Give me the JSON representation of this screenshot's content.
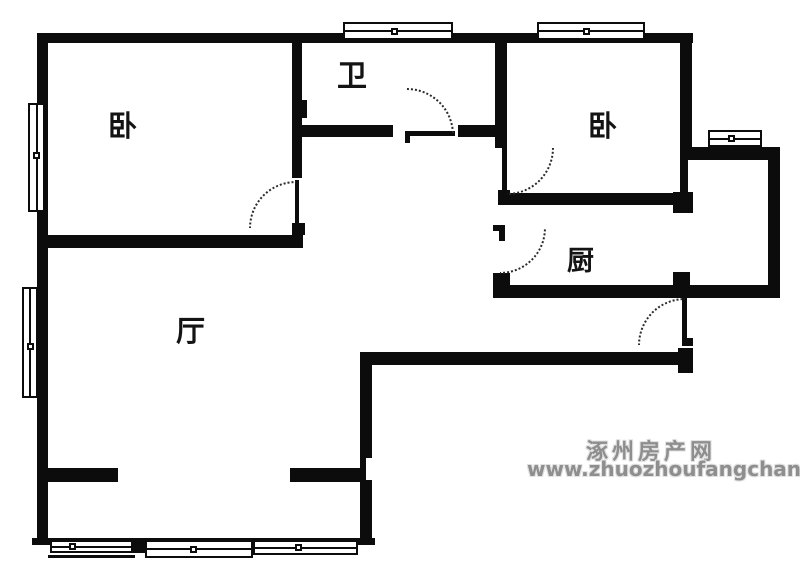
{
  "title": "apartment floor plan",
  "colors": {
    "wall": "#0c0c0c",
    "background": "#ffffff",
    "arc": "#2b2b2b",
    "watermark": "#8e8e8e"
  },
  "rooms": [
    {
      "id": "bedroom-left",
      "label": "卧",
      "x": 108,
      "y": 112,
      "size": 29
    },
    {
      "id": "bathroom",
      "label": "卫",
      "x": 337,
      "y": 62,
      "size": 30
    },
    {
      "id": "bedroom-right",
      "label": "卧",
      "x": 588,
      "y": 112,
      "size": 29
    },
    {
      "id": "kitchen",
      "label": "厨",
      "x": 567,
      "y": 248,
      "size": 27
    },
    {
      "id": "living-room",
      "label": "厅",
      "x": 176,
      "y": 317,
      "size": 29
    }
  ],
  "watermark": {
    "line1": "涿州房产网",
    "line2": "www.zhuozhoufangchan.com",
    "pos1": {
      "x": 586,
      "y": 434,
      "size": 22
    },
    "pos2": {
      "x": 527,
      "y": 457,
      "size": 20
    }
  },
  "plan": {
    "walls": [
      {
        "x": 37,
        "y": 33,
        "w": 656,
        "h": 10
      },
      {
        "x": 37,
        "y": 33,
        "w": 11,
        "h": 512
      },
      {
        "x": 32,
        "y": 538,
        "w": 343,
        "h": 7
      },
      {
        "x": 360,
        "y": 352,
        "w": 12,
        "h": 193
      },
      {
        "x": 360,
        "y": 352,
        "w": 333,
        "h": 13
      },
      {
        "x": 678,
        "y": 348,
        "w": 15,
        "h": 25
      },
      {
        "x": 493,
        "y": 285,
        "w": 287,
        "h": 13
      },
      {
        "x": 768,
        "y": 147,
        "w": 12,
        "h": 151
      },
      {
        "x": 688,
        "y": 147,
        "w": 92,
        "h": 13
      },
      {
        "x": 680,
        "y": 33,
        "w": 12,
        "h": 122
      },
      {
        "x": 680,
        "y": 155,
        "w": 8,
        "h": 58
      },
      {
        "x": 673,
        "y": 272,
        "w": 17,
        "h": 13
      },
      {
        "x": 673,
        "y": 192,
        "w": 20,
        "h": 21
      },
      {
        "x": 37,
        "y": 235,
        "w": 266,
        "h": 13
      },
      {
        "x": 292,
        "y": 43,
        "w": 10,
        "h": 135
      },
      {
        "x": 300,
        "y": 100,
        "w": 7,
        "h": 18
      },
      {
        "x": 292,
        "y": 223,
        "w": 13,
        "h": 12
      },
      {
        "x": 302,
        "y": 125,
        "w": 91,
        "h": 12
      },
      {
        "x": 458,
        "y": 125,
        "w": 39,
        "h": 12
      },
      {
        "x": 495,
        "y": 43,
        "w": 12,
        "h": 105
      },
      {
        "x": 498,
        "y": 190,
        "w": 12,
        "h": 15
      },
      {
        "x": 498,
        "y": 193,
        "w": 195,
        "h": 12
      },
      {
        "x": 493,
        "y": 225,
        "w": 12,
        "h": 6
      },
      {
        "x": 499,
        "y": 225,
        "w": 6,
        "h": 16
      },
      {
        "x": 493,
        "y": 273,
        "w": 17,
        "h": 25
      },
      {
        "x": 48,
        "y": 468,
        "w": 70,
        "h": 14
      },
      {
        "x": 290,
        "y": 468,
        "w": 70,
        "h": 14
      },
      {
        "x": 133,
        "y": 538,
        "w": 12,
        "h": 15
      },
      {
        "x": 48,
        "y": 555,
        "w": 87,
        "h": 3
      }
    ],
    "cutouts": [
      {
        "x": 366,
        "y": 458,
        "w": 6,
        "h": 22
      }
    ],
    "windows": [
      {
        "x": 343,
        "y": 22,
        "w": 110,
        "h": 18,
        "o": "h",
        "f": 0.47
      },
      {
        "x": 537,
        "y": 22,
        "w": 108,
        "h": 18,
        "o": "h",
        "f": 0.46
      },
      {
        "x": 708,
        "y": 130,
        "w": 54,
        "h": 17,
        "o": "h",
        "f": 0.43
      },
      {
        "x": 28,
        "y": 103,
        "w": 17,
        "h": 109,
        "o": "v",
        "f": 0.49
      },
      {
        "x": 22,
        "y": 287,
        "w": 16,
        "h": 111,
        "o": "v",
        "f": 0.54
      },
      {
        "x": 50,
        "y": 540,
        "w": 83,
        "h": 13,
        "o": "h",
        "f": 0.27
      },
      {
        "x": 145,
        "y": 540,
        "w": 108,
        "h": 18,
        "o": "h",
        "f": 0.45
      },
      {
        "x": 253,
        "y": 540,
        "w": 105,
        "h": 15,
        "o": "h",
        "f": 0.44
      }
    ],
    "door_leaves": [
      {
        "x": 295,
        "y": 180,
        "w": 4,
        "h": 44
      },
      {
        "x": 405,
        "y": 131,
        "w": 50,
        "h": 5
      },
      {
        "x": 405,
        "y": 131,
        "w": 5,
        "h": 12
      },
      {
        "x": 502,
        "y": 147,
        "w": 5,
        "h": 46
      },
      {
        "x": 682,
        "y": 298,
        "w": 5,
        "h": 47
      },
      {
        "x": 682,
        "y": 338,
        "w": 11,
        "h": 8
      }
    ],
    "arcs": [
      {
        "x": 249,
        "y": 181,
        "r": 47,
        "q": "tl"
      },
      {
        "x": 407,
        "y": 88,
        "r": 47,
        "q": "tr"
      },
      {
        "x": 507,
        "y": 148,
        "r": 47,
        "q": "br"
      },
      {
        "x": 500,
        "y": 228,
        "r": 46,
        "q": "br"
      },
      {
        "x": 638,
        "y": 298,
        "r": 47,
        "q": "tl"
      }
    ]
  }
}
